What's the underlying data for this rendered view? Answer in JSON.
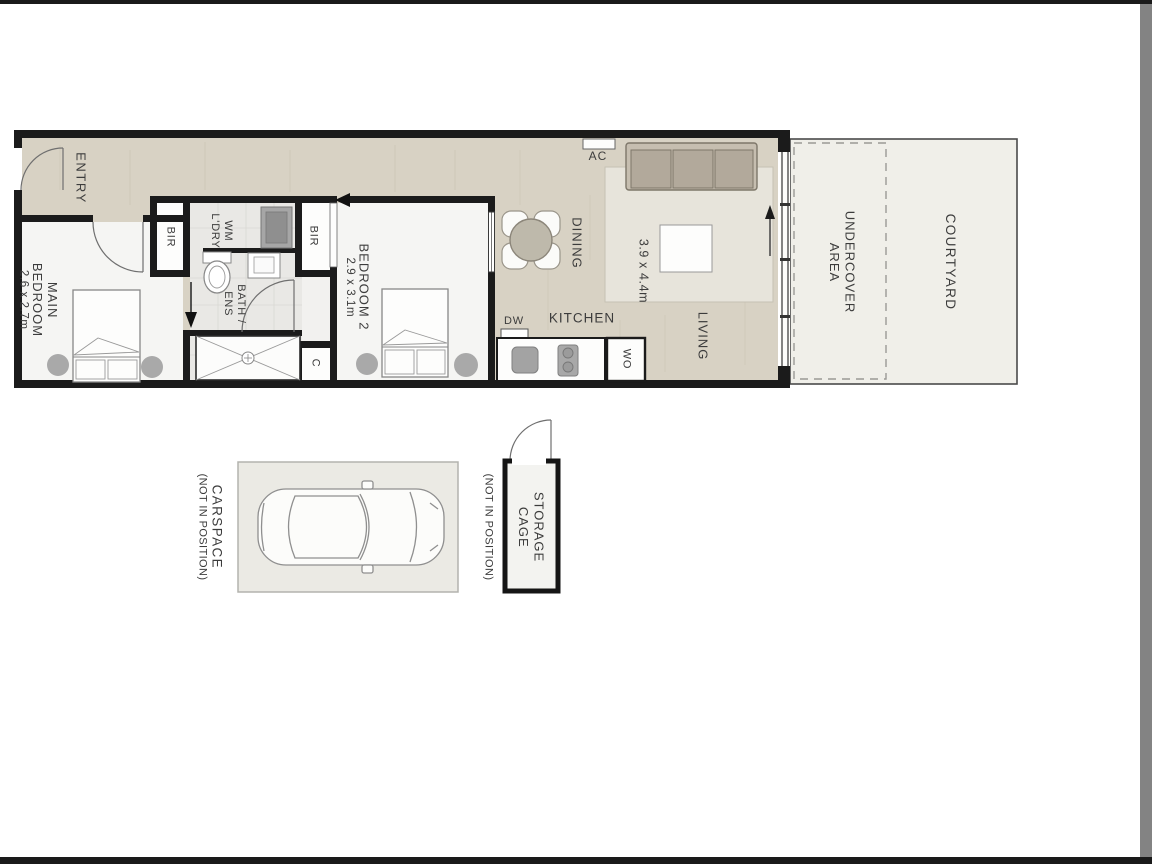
{
  "page": {
    "type": "floor-plan-image",
    "frame_color": "#1a1a1a",
    "scrollbar_color": "#838383",
    "background": "#ffffff"
  },
  "palette": {
    "wall": "#1b1b1b",
    "floor_main": "#d8d2c4",
    "floor_bedroom": "#f5f5f3",
    "floor_bath": "#e9e8e5",
    "floor_courtyard": "#f0efe9",
    "floor_carspace": "#ebeae4",
    "rug": "#e7e4db",
    "sofa": "#b2a99b",
    "appliance_gray": "#a6a6a6",
    "text": "#3c3c3c"
  },
  "labels": {
    "entry": "ENTRY",
    "main_bedroom_1": "MAIN",
    "main_bedroom_2": "BEDROOM",
    "main_bedroom_dims": "2.6 x 2.7m",
    "bir1": "BIR",
    "bir2": "BIR",
    "wm": "WM",
    "ldry": "L'DRY",
    "bath_1": "BATH /",
    "bath_2": "ENS",
    "cupboard": "C",
    "bedroom2": "BEDROOM 2",
    "bedroom2_dims": "2.9 x 3.1m",
    "dining": "DINING",
    "kitchen": "KITCHEN",
    "dw": "DW",
    "wo": "WO",
    "ac": "AC",
    "living": "LIVING",
    "living_dims": "3.9 x 4.4m",
    "undercover_1": "UNDERCOVER",
    "undercover_2": "AREA",
    "courtyard": "COURTYARD",
    "carspace": "CARSPACE",
    "carspace_note": "(NOT IN POSITION)",
    "storage_1": "STORAGE",
    "storage_2": "CAGE",
    "storage_note": "(NOT IN POSITION)"
  }
}
